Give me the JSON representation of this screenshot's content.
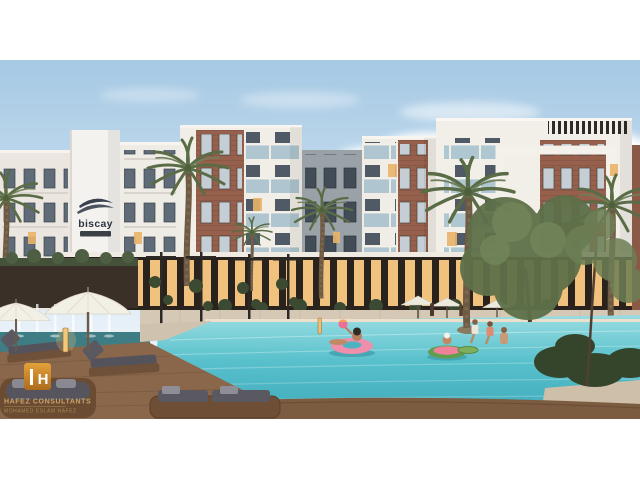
{
  "scene": {
    "title": "Residential compound exterior rendering",
    "description": "Dusk view of a modern apartment complex with a turquoise pool, palm trees, white umbrellas, wooden deck loungers and people on pool floats"
  },
  "building_logo": {
    "name": "biscay"
  },
  "watermark": {
    "monogram": "H",
    "line1": "HAFEZ CONSULTANTS",
    "line2": "MOHAMED ESLAM HAFEZ"
  },
  "palette": {
    "sky_top": "#a6c9e4",
    "sky_horizon": "#e8f1f8",
    "cloud": "#ffffff",
    "facade_white": "#f0ece6",
    "facade_gray": "#9aa1a7",
    "brick": "#96604c",
    "glass_dark": "#5f6b77",
    "window_lit": "#e9b469",
    "pool_far": "#9adde2",
    "pool_near": "#3fa9ba",
    "stone": "#d5c9b6",
    "deck_wood": "#8a664a",
    "umbrella": "#f2efe7",
    "palm_green": "#5a6c46",
    "float_pink": "#ef8fac",
    "float_green": "#5f9e4f",
    "watermark_orange": "#d8962f",
    "watermark_gold": "#c9a56b",
    "letterbox": "#ffffff"
  }
}
